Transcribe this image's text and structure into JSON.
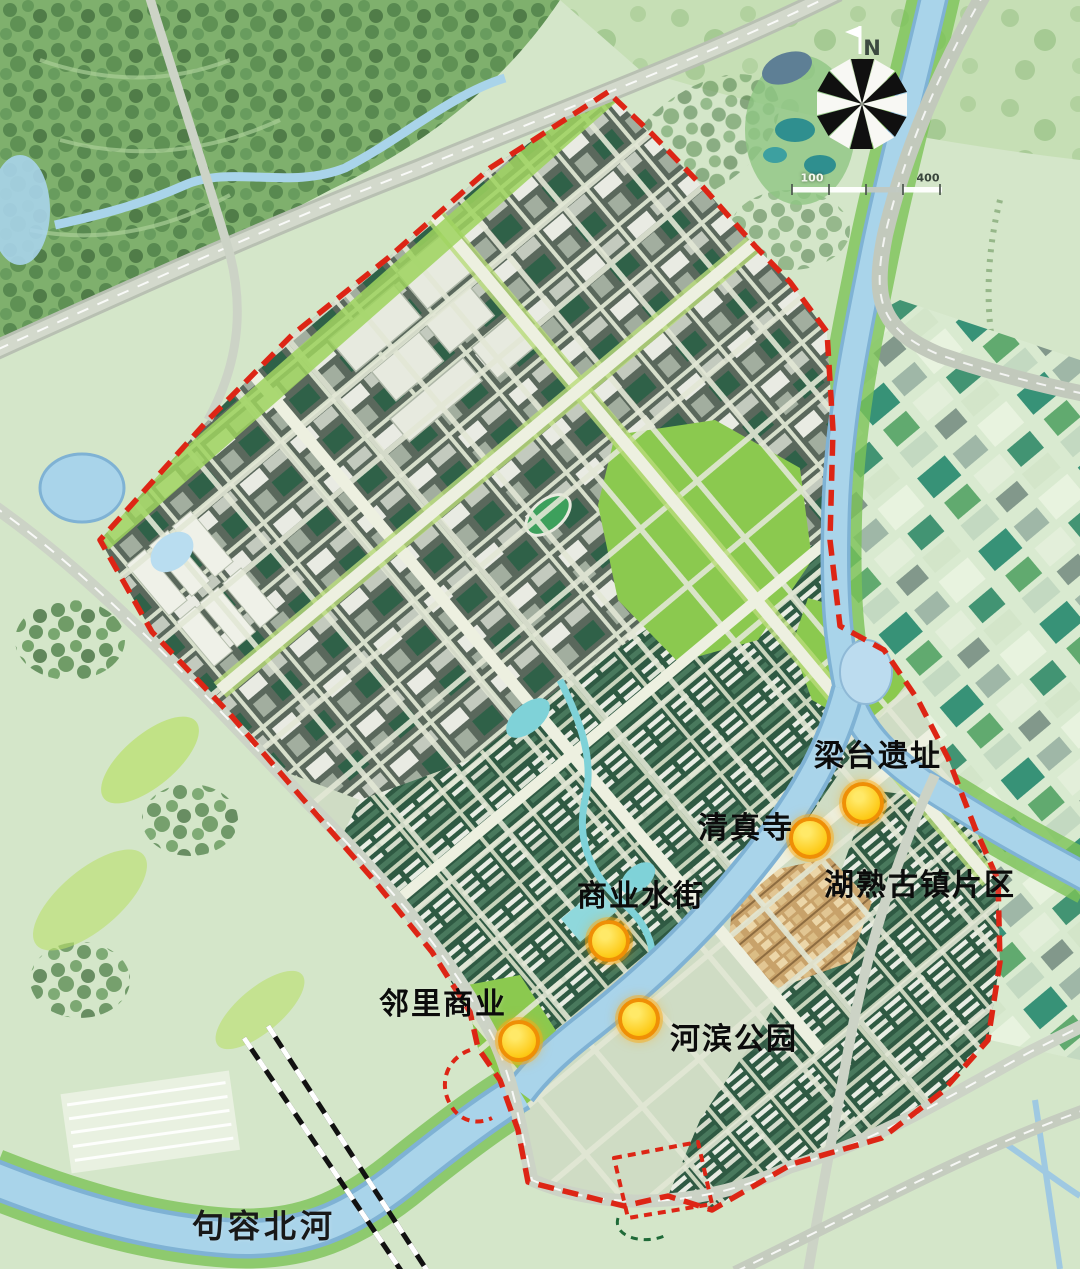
{
  "map": {
    "pois": [
      {
        "id": "liangtai-ruins",
        "label": "梁台遗址",
        "has_dot": true
      },
      {
        "id": "qingzhen-mosque",
        "label": "清真寺",
        "has_dot": true
      },
      {
        "id": "commercial-water-street",
        "label": "商业水街",
        "has_dot": true
      },
      {
        "id": "hushu-ancient-town-area",
        "label": "湖熟古镇片区",
        "has_dot": false
      },
      {
        "id": "neighborhood-commerce",
        "label": "邻里商业",
        "has_dot": true
      },
      {
        "id": "riverside-park",
        "label": "河滨公园",
        "has_dot": true
      },
      {
        "id": "jurong-north-river",
        "label": "句容北河",
        "has_dot": false
      }
    ],
    "compass": {
      "north_label": "N"
    },
    "scale_bar": {
      "left_label": "100",
      "right_label": "400"
    },
    "boundary_style": "red-dashed planning boundary",
    "railway_style": "black-white dashed railway",
    "colors": {
      "background": "#d4e6c9",
      "boundary": "#dd2515",
      "poi_dot": "#ffd83b",
      "poi_dot_ring": "#ef8f06",
      "water": "#a9d4ea",
      "park": "#8bc94f",
      "industrial_block": "#5a685c",
      "residential_block": "#2f5a43",
      "ancient_town": "#c8a26a",
      "road": "#ccd3c6",
      "forest": "#7fb06d"
    }
  }
}
